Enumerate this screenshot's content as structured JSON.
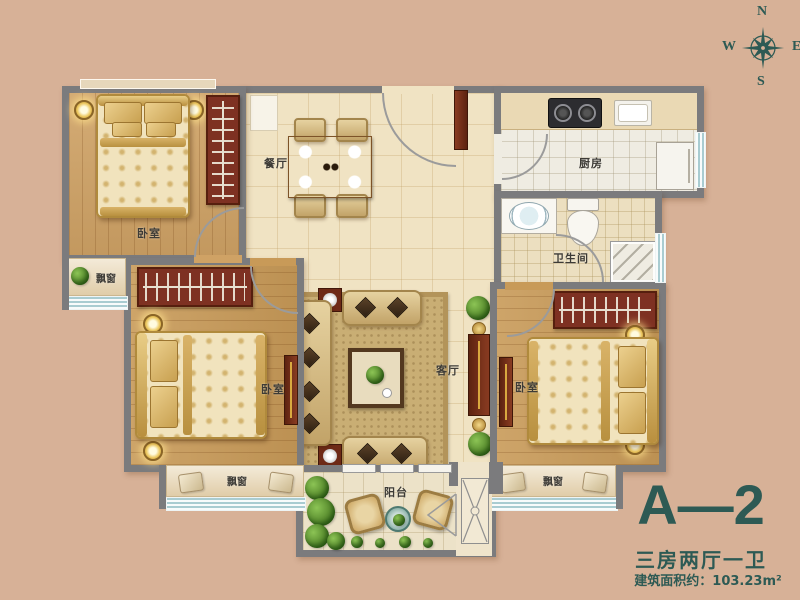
{
  "colors": {
    "background": "#d7b197",
    "wall": "#7b7b7d",
    "accent_teal": "#2d5a54",
    "wood_floor": "#cfa265",
    "tile_floor": "#f0e3c3",
    "furniture_red": "#7e3122",
    "window_blue": "#a9ccd1"
  },
  "compass": {
    "north": "N",
    "east": "E",
    "south": "S",
    "west": "W"
  },
  "title_block": {
    "unit_code": "A—2",
    "layout_type": "三房两厅一卫",
    "area_label": "建筑面积约：103.23m²"
  },
  "room_labels": {
    "bedroom_top_left": "卧室",
    "bedroom_bottom_left": "卧室",
    "bedroom_bottom_right": "卧室",
    "dining_room": "餐厅",
    "living_room": "客厅",
    "kitchen": "厨房",
    "bathroom": "卫生间",
    "balcony": "阳台",
    "bay_window_top_left": "飘窗",
    "bay_window_bottom_left": "飘窗",
    "bay_window_bottom_right": "飘窗"
  }
}
